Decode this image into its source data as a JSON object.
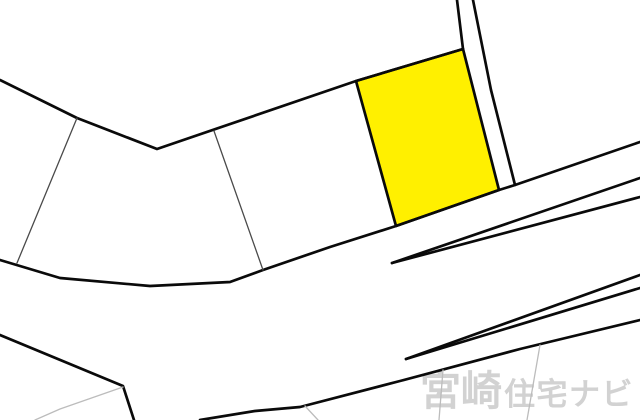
{
  "watermark": {
    "primary": "宮崎",
    "secondary": "住宅ナビ",
    "color": "#d2d2d2"
  },
  "map": {
    "width": 640,
    "height": 420,
    "background_color": "#ffffff",
    "line_color": "#0a0a0a",
    "thin_line_color": "#4a4a4a",
    "faint_line_color": "#bcbcbc",
    "highlight_parcel": {
      "name": "highlighted-lot",
      "fill": "#fff000",
      "points": [
        [
          356,
          81
        ],
        [
          463,
          49
        ],
        [
          499,
          190
        ],
        [
          396,
          226
        ]
      ]
    },
    "boundaries": [
      {
        "name": "boundary-upper-left",
        "kind": "thick",
        "points": [
          [
            0,
            80
          ],
          [
            77,
            118
          ],
          [
            157,
            149
          ],
          [
            356,
            81
          ],
          [
            463,
            49
          ]
        ]
      },
      {
        "name": "strip-left-line",
        "kind": "thick",
        "points": [
          [
            463,
            49
          ],
          [
            457,
            0
          ]
        ]
      },
      {
        "name": "strip-right-line",
        "kind": "thick",
        "points": [
          [
            473,
            0
          ],
          [
            491,
            90
          ],
          [
            515,
            185
          ]
        ]
      },
      {
        "name": "road-upper-edge",
        "kind": "thick",
        "points": [
          [
            0,
            260
          ],
          [
            60,
            278
          ],
          [
            150,
            286
          ],
          [
            230,
            282
          ],
          [
            263,
            270
          ],
          [
            330,
            247
          ],
          [
            396,
            226
          ],
          [
            499,
            190
          ],
          [
            515,
            185
          ],
          [
            640,
            142
          ]
        ]
      },
      {
        "name": "road-mid-wedge-upper",
        "kind": "thick",
        "points": [
          [
            392,
            263
          ],
          [
            640,
            178
          ]
        ]
      },
      {
        "name": "road-mid-wedge-lower",
        "kind": "thick",
        "points": [
          [
            392,
            263
          ],
          [
            640,
            197
          ]
        ]
      },
      {
        "name": "boundary-lower-left",
        "kind": "thick",
        "points": [
          [
            0,
            335
          ],
          [
            123,
            386
          ],
          [
            134,
            420
          ]
        ]
      },
      {
        "name": "road-lower-edge",
        "kind": "thick",
        "points": [
          [
            200,
            420
          ],
          [
            255,
            411
          ],
          [
            300,
            407
          ],
          [
            400,
            381
          ],
          [
            520,
            349
          ],
          [
            640,
            320
          ]
        ]
      },
      {
        "name": "road-lower-wedge-upper",
        "kind": "thick",
        "points": [
          [
            406,
            359
          ],
          [
            640,
            275
          ]
        ]
      },
      {
        "name": "road-lower-wedge-lower",
        "kind": "thick",
        "points": [
          [
            406,
            359
          ],
          [
            640,
            288
          ]
        ]
      },
      {
        "name": "parcel-line-left",
        "kind": "thin",
        "points": [
          [
            77,
            118
          ],
          [
            17,
            263
          ]
        ]
      },
      {
        "name": "parcel-line-center",
        "kind": "thin",
        "points": [
          [
            214,
            131
          ],
          [
            263,
            270
          ]
        ]
      },
      {
        "name": "faint-parcel-line-sw",
        "kind": "faint",
        "points": [
          [
            35,
            420
          ],
          [
            60,
            409
          ],
          [
            123,
            387
          ]
        ]
      },
      {
        "name": "faint-parcel-line-south",
        "kind": "faint",
        "points": [
          [
            305,
            406
          ],
          [
            318,
            420
          ]
        ]
      },
      {
        "name": "faint-parcel-line-se-1",
        "kind": "faint",
        "points": [
          [
            443,
            370
          ],
          [
            439,
            420
          ]
        ]
      },
      {
        "name": "faint-parcel-line-se-2",
        "kind": "faint",
        "points": [
          [
            540,
            345
          ],
          [
            527,
            420
          ]
        ]
      }
    ]
  }
}
